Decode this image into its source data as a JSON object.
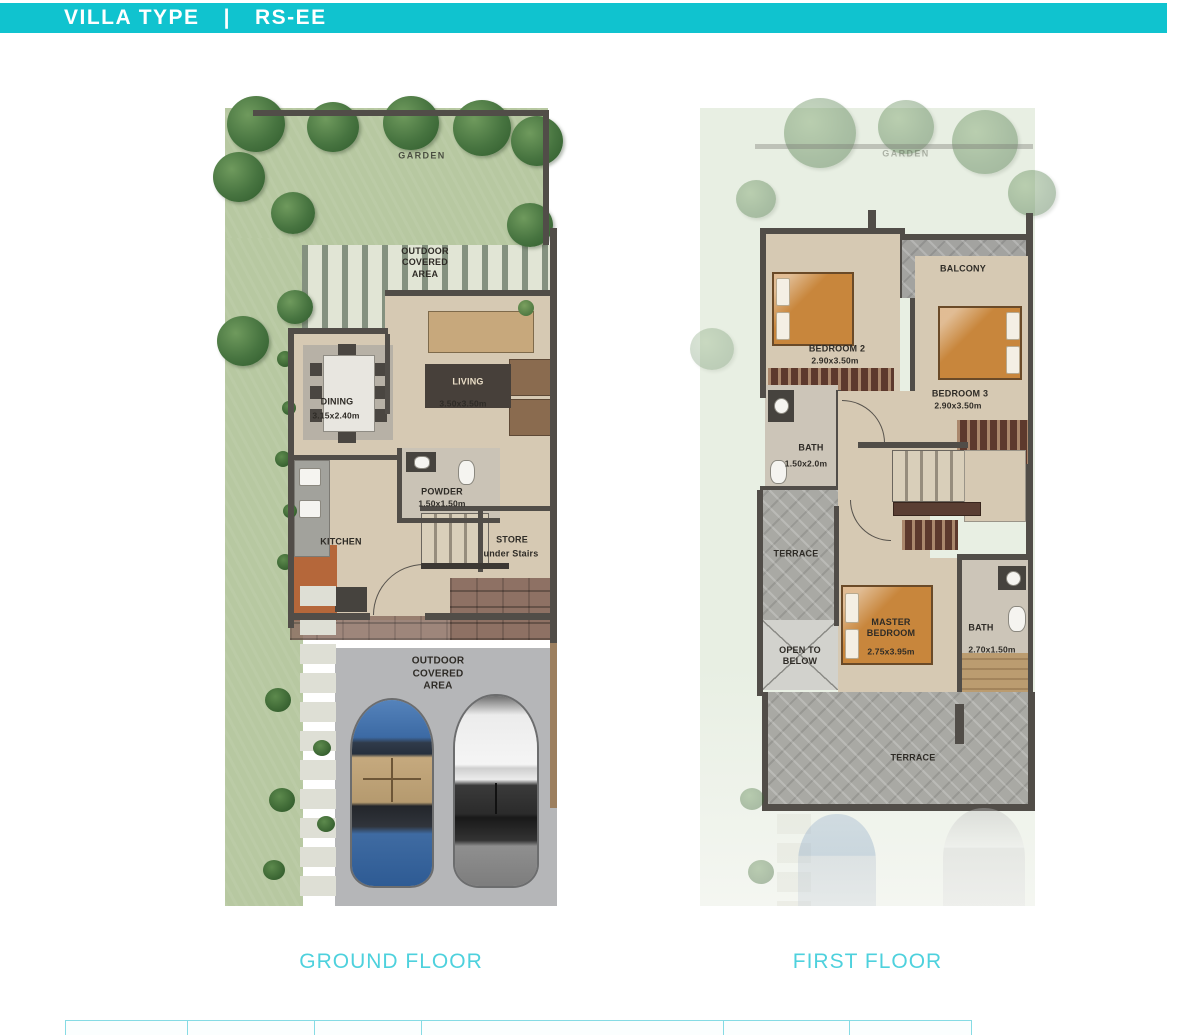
{
  "header": {
    "title": "VILLA TYPE",
    "separator": "|",
    "code": "RS-EE"
  },
  "captions": {
    "ground": "GROUND FLOOR",
    "first": "FIRST FLOOR"
  },
  "ground_floor": {
    "garden": "GARDEN",
    "outdoor_covered_top": "OUTDOOR COVERED AREA",
    "living": {
      "name": "LIVING",
      "dims": "3.50x3.50m"
    },
    "dining": {
      "name": "DINING",
      "dims": "3.15x2.40m"
    },
    "powder": {
      "name": "POWDER",
      "dims": "1.50x1.50m"
    },
    "kitchen": "KITCHEN",
    "store": {
      "name": "STORE",
      "sub": "under Stairs"
    },
    "outdoor_covered_bottom": "OUTDOOR COVERED AREA"
  },
  "first_floor": {
    "garden": "GARDEN",
    "balcony": "BALCONY",
    "bedroom2": {
      "name": "BEDROOM 2",
      "dims": "2.90x3.50m"
    },
    "bedroom3": {
      "name": "BEDROOM 3",
      "dims": "2.90x3.50m"
    },
    "bath1": {
      "name": "BATH",
      "dims": "1.50x2.0m"
    },
    "terrace_mid": "TERRACE",
    "open_to_below": "OPEN TO BELOW",
    "master": {
      "name": "MASTER BEDROOM",
      "dims": "2.75x3.95m"
    },
    "bath2": {
      "name": "BATH",
      "dims": "2.70x1.50m"
    },
    "terrace_bottom": "TERRACE"
  },
  "colors": {
    "header_bg": "#10c3cf",
    "caption_text": "#4ed1dd",
    "wall": "#514d48",
    "garden_green": "#b7c8a1",
    "floor_beige": "#d6c9b3",
    "parking_gray": "#b5b6b8",
    "terrace_stone": "#a9a9a4",
    "bed_orange": "#c8863c",
    "car_blue": "#36639c",
    "car_white": "#e9e9e9"
  }
}
